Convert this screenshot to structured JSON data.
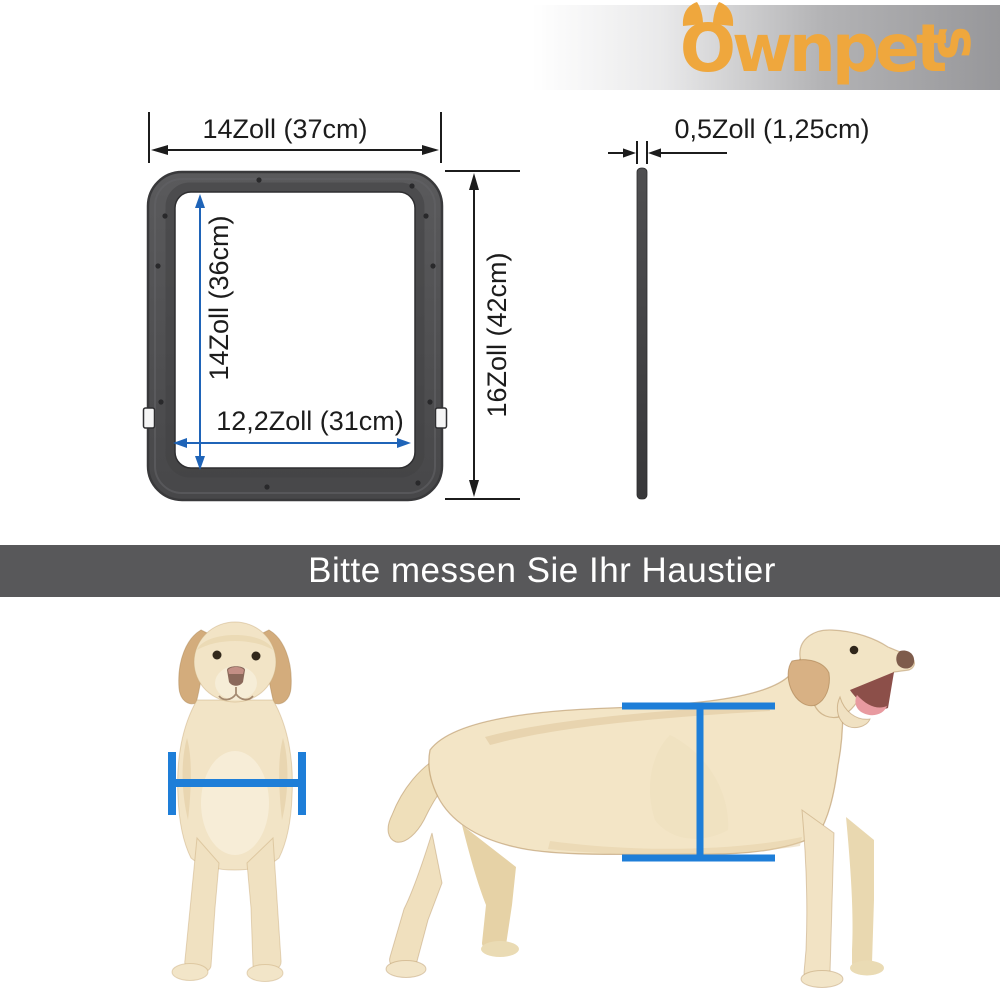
{
  "brand": {
    "name": "Ownpets",
    "logo_main": "Ownpet",
    "logo_tail": "s",
    "logo_color": "#EFA73D"
  },
  "diagram": {
    "front_view": {
      "outer_width": "14Zoll (37cm)",
      "inner_height": "14Zoll (36cm)",
      "inner_width": "12,2Zoll (31cm)",
      "outer_height": "16Zoll (42cm)"
    },
    "side_view": {
      "thickness": "0,5Zoll (1,25cm)"
    }
  },
  "banner": {
    "text": "Bitte messen Sie Ihr Haustier",
    "bg_color": "#58585A",
    "text_color": "#FFFFFF"
  },
  "colors": {
    "measure_blue": "#1E7ED8",
    "arrow_blue": "#1F64B8",
    "dimension_black": "#1C1C1C",
    "frame_gray": "#4E4E50",
    "logo_band_gray": "#97979A"
  }
}
